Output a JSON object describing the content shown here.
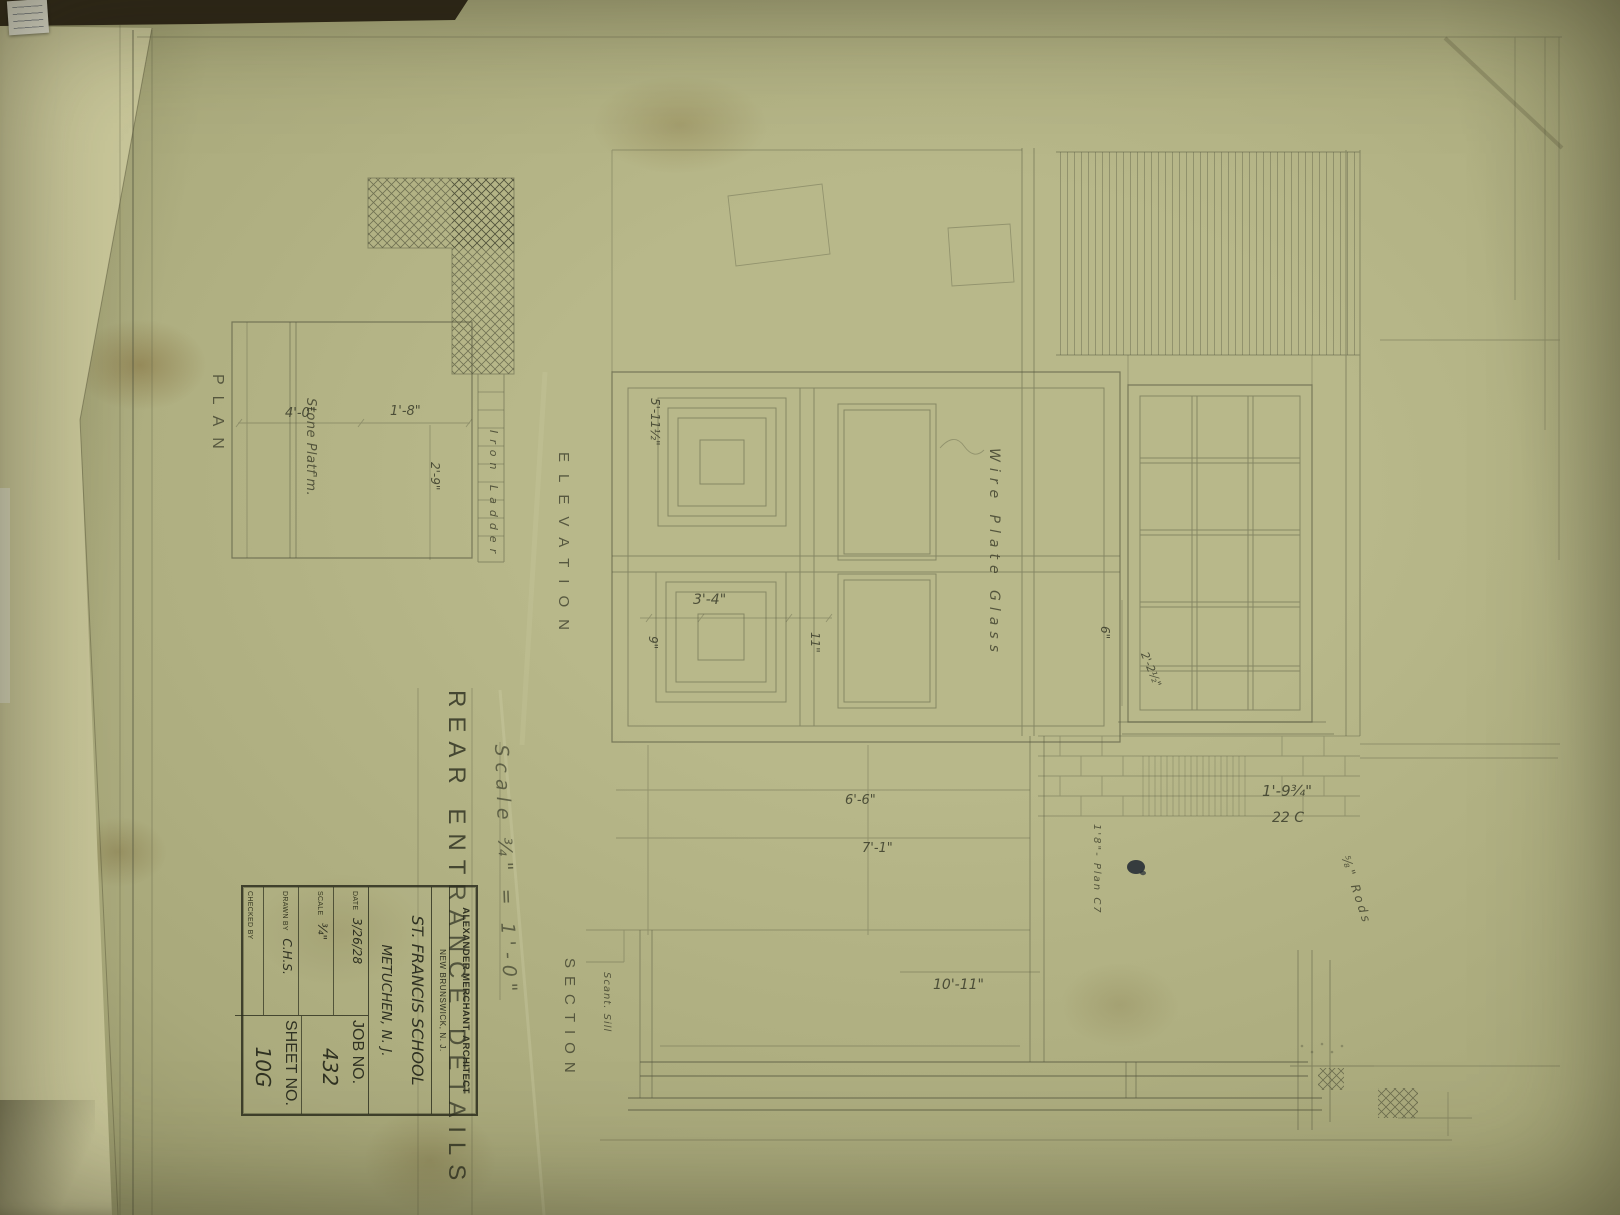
{
  "colors": {
    "paper": "#b4b485",
    "pencil": "#565840",
    "stamp_ink": "#2f3122",
    "backdrop": "#2b2416",
    "ink_blot": "#242b34"
  },
  "title": {
    "text": "REAR ENTRANCE DETAILS",
    "scale_note": "Scale ¾\" = 1'-0\""
  },
  "view_labels": {
    "plan": "PLAN",
    "elevation": "ELEVATION",
    "section": "SECTION"
  },
  "annotations": {
    "stone_platform": "Stone Platf'm.",
    "iron_ladder": "Iron Ladder",
    "wire_plate_glass": "Wire Plate Glass",
    "scant_sill": "Scant. Sill",
    "rods": "⅝\" Rods",
    "plan_ref": "1'8\"- Plan C7"
  },
  "dimensions": {
    "platform_width": "4'-0\"",
    "platform_depth": "1'-8\"",
    "platform_side": "2'-9\"",
    "door_panel": "3'-4\"",
    "door_height": "5'-11½\"",
    "left_stile": "9\"",
    "right_stile": "11\"",
    "window_head": "6\"",
    "window_width": "2'-2½\"",
    "course_height": "1'-9¾\"",
    "gauge": "22 C",
    "landing_a": "6'-6\"",
    "landing_b": "7'-1\"",
    "section_width": "10'-11\""
  },
  "title_block": {
    "architect": "ALEXANDER MERCHANT, ARCHITECT",
    "architect_city": "NEW BRUNSWICK, N. J.",
    "project": "ST. FRANCIS SCHOOL",
    "project_city": "METUCHEN, N. J.",
    "date_label": "DATE",
    "date_value": "3/26/28",
    "scale_label": "SCALE",
    "scale_value": "¾\"",
    "drawn_label": "DRAWN BY",
    "drawn_value": "C.H.S.",
    "checked_label": "CHECKED BY",
    "job_label": "JOB NO.",
    "job_value": "432",
    "sheet_label": "SHEET NO.",
    "sheet_value": "10G"
  }
}
